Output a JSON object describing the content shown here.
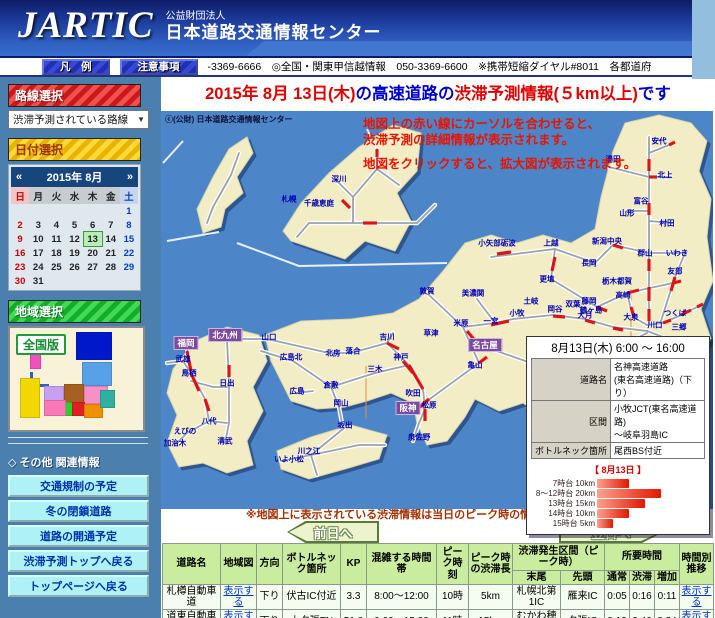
{
  "header": {
    "logo": "JARTIC",
    "org_type": "公益財団法人",
    "org_name": "日本道路交通情報センター"
  },
  "navbar": {
    "legend_button": "凡　例",
    "notes_button": "注意事項",
    "phone_info": "-3369-6666　◎全国・関東甲信越情報　050-3369-6600　※携帯短縮ダイヤル#8011　各都道府"
  },
  "sidebar": {
    "route_select_header": "路線選択",
    "route_dropdown": "渋滞予測されている路線",
    "date_select_header": "日付選択",
    "calendar": {
      "title": "2015年 8月",
      "prev": "«",
      "next": "»",
      "selected": "13",
      "weekdays": [
        "日",
        "月",
        "火",
        "水",
        "木",
        "金",
        "土"
      ],
      "weeks": [
        [
          "",
          "",
          "",
          "",
          "",
          "",
          "1"
        ],
        [
          "2",
          "3",
          "4",
          "5",
          "6",
          "7",
          "8"
        ],
        [
          "9",
          "10",
          "11",
          "12",
          "13",
          "14",
          "15"
        ],
        [
          "16",
          "17",
          "18",
          "19",
          "20",
          "21",
          "22"
        ],
        [
          "23",
          "24",
          "25",
          "26",
          "27",
          "28",
          "29"
        ],
        [
          "30",
          "31",
          "",
          "",
          "",
          "",
          ""
        ]
      ]
    },
    "region_select_header": "地域選択",
    "zenkoku_button": "全国版",
    "other_info_header": "◇ その他 関連情報",
    "links": [
      "交通規制の予定",
      "冬の閉鎖道路",
      "道路の開通予定",
      "渋滞予測トップへ戻る",
      "トップページへ戻る"
    ]
  },
  "main_title": {
    "date": "2015年 8月 13日(木)",
    "mid": "の高速道路の",
    "info": "渋滞予測情報(５km以上)",
    "suffix": "です"
  },
  "map": {
    "copyright": "ⓒ(公財) 日本道路交通情報センター",
    "instructions": [
      "地図上の赤い線にカーソルを合わせると、",
      "渋滞予測の詳細情報が表示されます。",
      "地図をクリックすると、拡大図が表示されます。"
    ],
    "city_boxes": [
      {
        "t": "福岡",
        "x": 25,
        "y": 232
      },
      {
        "t": "北九州",
        "x": 64,
        "y": 224
      },
      {
        "t": "阪神",
        "x": 247,
        "y": 297
      },
      {
        "t": "名古屋",
        "x": 324,
        "y": 234
      }
    ],
    "labels": [
      {
        "t": "深川",
        "x": 178,
        "y": 68
      },
      {
        "t": "札幌",
        "x": 128,
        "y": 88
      },
      {
        "t": "千歳恵庭",
        "x": 158,
        "y": 92
      },
      {
        "t": "安代",
        "x": 498,
        "y": 30
      },
      {
        "t": "湯田",
        "x": 452,
        "y": 48
      },
      {
        "t": "北上",
        "x": 504,
        "y": 64
      },
      {
        "t": "富谷",
        "x": 480,
        "y": 90
      },
      {
        "t": "山形",
        "x": 466,
        "y": 102
      },
      {
        "t": "村田",
        "x": 506,
        "y": 112
      },
      {
        "t": "新潟中央",
        "x": 446,
        "y": 130
      },
      {
        "t": "郡山",
        "x": 484,
        "y": 142
      },
      {
        "t": "いわき",
        "x": 516,
        "y": 142
      },
      {
        "t": "小矢部砺波",
        "x": 336,
        "y": 132
      },
      {
        "t": "上越",
        "x": 390,
        "y": 132
      },
      {
        "t": "長岡",
        "x": 428,
        "y": 152
      },
      {
        "t": "友部",
        "x": 514,
        "y": 160
      },
      {
        "t": "栃木都賀",
        "x": 456,
        "y": 170
      },
      {
        "t": "更埴",
        "x": 386,
        "y": 168
      },
      {
        "t": "敦賀",
        "x": 266,
        "y": 180
      },
      {
        "t": "美濃関",
        "x": 312,
        "y": 182
      },
      {
        "t": "高崎",
        "x": 462,
        "y": 184
      },
      {
        "t": "藤岡",
        "x": 428,
        "y": 190
      },
      {
        "t": "鶴ヶ島",
        "x": 430,
        "y": 199
      },
      {
        "t": "岡谷",
        "x": 394,
        "y": 198
      },
      {
        "t": "土岐",
        "x": 370,
        "y": 190
      },
      {
        "t": "双葉",
        "x": 412,
        "y": 193
      },
      {
        "t": "大月",
        "x": 424,
        "y": 204
      },
      {
        "t": "大泉",
        "x": 470,
        "y": 206
      },
      {
        "t": "つくば",
        "x": 514,
        "y": 202
      },
      {
        "t": "小牧",
        "x": 356,
        "y": 202
      },
      {
        "t": "一宮",
        "x": 330,
        "y": 210
      },
      {
        "t": "米原",
        "x": 300,
        "y": 212
      },
      {
        "t": "川口",
        "x": 494,
        "y": 214
      },
      {
        "t": "三郷",
        "x": 518,
        "y": 216
      },
      {
        "t": "草津",
        "x": 270,
        "y": 222
      },
      {
        "t": "亀山",
        "x": 314,
        "y": 254
      },
      {
        "t": "吉川",
        "x": 226,
        "y": 226
      },
      {
        "t": "神戸",
        "x": 240,
        "y": 246
      },
      {
        "t": "三木",
        "x": 214,
        "y": 258
      },
      {
        "t": "吹田",
        "x": 252,
        "y": 282
      },
      {
        "t": "松原",
        "x": 268,
        "y": 294
      },
      {
        "t": "泉佐野",
        "x": 258,
        "y": 326
      },
      {
        "t": "山口",
        "x": 108,
        "y": 226
      },
      {
        "t": "広島北",
        "x": 130,
        "y": 246
      },
      {
        "t": "広島",
        "x": 136,
        "y": 280
      },
      {
        "t": "北房",
        "x": 172,
        "y": 242
      },
      {
        "t": "落合",
        "x": 192,
        "y": 240
      },
      {
        "t": "倉敷",
        "x": 170,
        "y": 274
      },
      {
        "t": "岡山",
        "x": 180,
        "y": 292
      },
      {
        "t": "坂出",
        "x": 184,
        "y": 314
      },
      {
        "t": "川之江",
        "x": 148,
        "y": 340
      },
      {
        "t": "いよ小松",
        "x": 128,
        "y": 348
      },
      {
        "t": "武雄",
        "x": 22,
        "y": 248
      },
      {
        "t": "鳥栖",
        "x": 28,
        "y": 262
      },
      {
        "t": "日出",
        "x": 66,
        "y": 272
      },
      {
        "t": "八代",
        "x": 48,
        "y": 310
      },
      {
        "t": "えびの",
        "x": 24,
        "y": 320
      },
      {
        "t": "加治木",
        "x": 14,
        "y": 332
      },
      {
        "t": "清武",
        "x": 64,
        "y": 330
      }
    ]
  },
  "tooltip": {
    "title": "8月13日(木) 6:00 ～ 16:00",
    "rows": [
      {
        "label": "道路名",
        "value": "名神高速道路\n(東名高速道路)（下り）"
      },
      {
        "label": "区間",
        "value": "小牧JCT(東名高速道路)\n～岐阜羽島IC"
      },
      {
        "label": "ボトルネック箇所",
        "value": "尾西BS付近"
      }
    ],
    "caption": "【 8月13日 】",
    "chart": {
      "type": "bar",
      "unit": "km",
      "categories": [
        "7時台",
        "8～12時台",
        "13時台",
        "14時台",
        "15時台"
      ],
      "values": [
        10,
        20,
        15,
        10,
        5
      ]
    }
  },
  "note": "※地図上に表示されている渋滞情報は当日のピーク時の情報を集めたものです",
  "nav_buttons": {
    "prev": "前日へ",
    "next": "翌日へ"
  },
  "table": {
    "headers": {
      "road": "道路名",
      "areamap": "地域図",
      "direction": "方向",
      "bottleneck": "ボトルネック箇所",
      "kp": "KP",
      "busy_hours": "混雑する時間帯",
      "peak_time": "ピーク時刻",
      "peak_length": "ピーク時の渋滞長",
      "jam_section": "渋滞発生区間（ピーク時）",
      "tail": "末尾",
      "head": "先頭",
      "travel_time": "所要時間",
      "normal": "通常",
      "jam": "渋滞",
      "increase": "増加",
      "hourly": "時間別推移"
    },
    "rows": [
      {
        "road": "札樽自動車道",
        "areamap": "表示する",
        "direction": "下り",
        "bottleneck": "伏古IC付近",
        "kp": "3.3",
        "busy_hours": "8:00～12:00",
        "peak_time": "10時",
        "peak_length": "5km",
        "tail": "札幌北第1IC",
        "head": "雁来IC",
        "normal": "0:05",
        "jam": "0:16",
        "increase": "0:11",
        "hourly": "表示する"
      },
      {
        "road": "道東自動車道",
        "areamap": "表示する",
        "direction": "下り",
        "bottleneck": "大夕張TN",
        "kp": "51.0",
        "busy_hours": "9:00～15:00",
        "peak_time": "11時",
        "peak_length": "15km",
        "tail": "むかわ穂別IC",
        "head": "夕張IC",
        "normal": "0:12",
        "jam": "0:46",
        "increase": "0:34",
        "hourly": "表示する"
      }
    ]
  }
}
